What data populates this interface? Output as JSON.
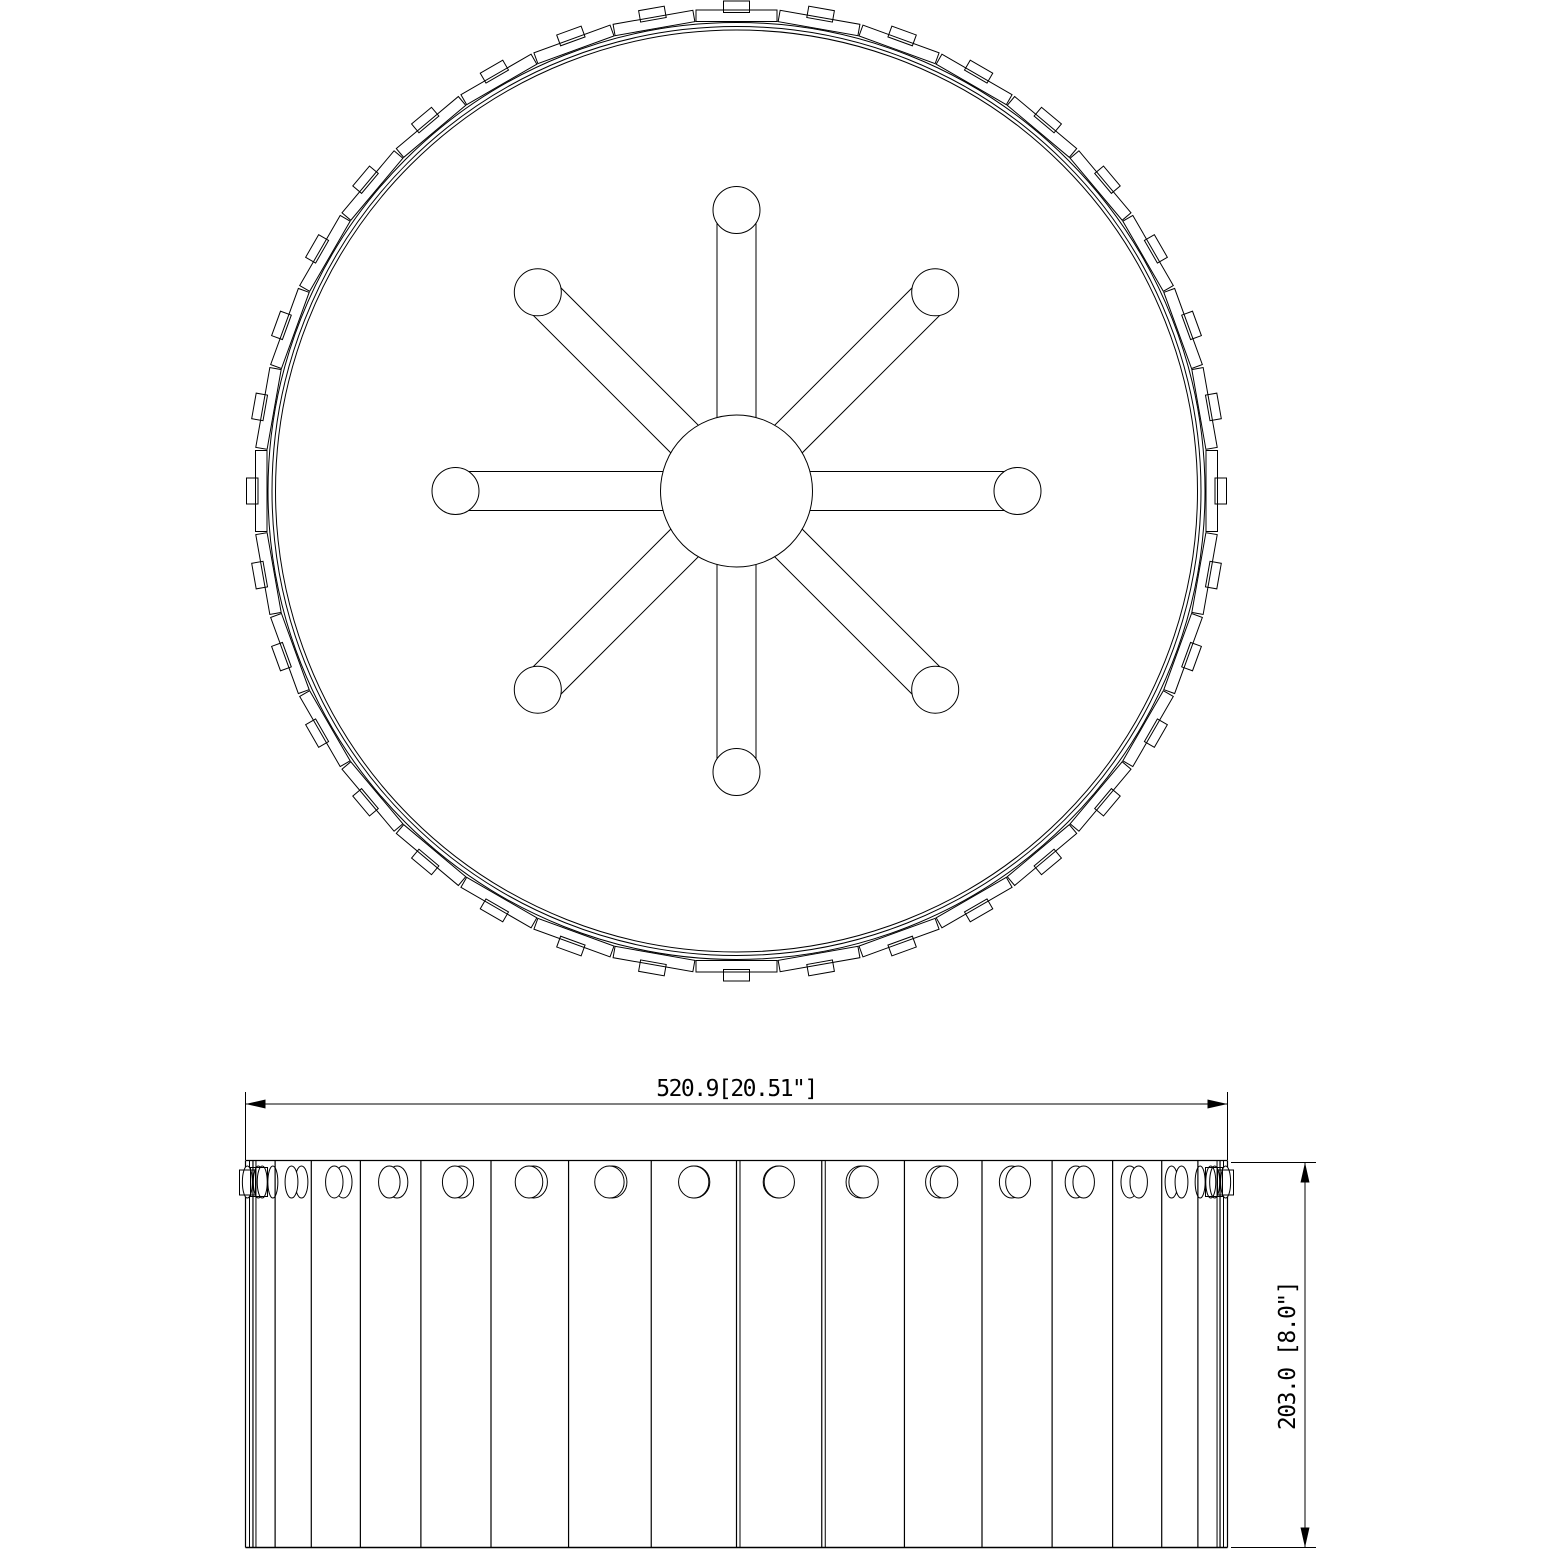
{
  "drawing": {
    "line_color": "#000000",
    "background_color": "#ffffff",
    "top_view": {
      "cx": 736.5,
      "cy": 491,
      "hub_radius": 76,
      "rim_radii": [
        461,
        464.5,
        468.5
      ],
      "panels": {
        "count": 36,
        "angle_step_deg": 10,
        "inner_radius": 469.5,
        "thickness": 11.5,
        "length": 81
      },
      "tabs": {
        "count": 36,
        "angle_step_deg": 10,
        "inner_radius": 478.5,
        "thickness": 11.5,
        "length": 26
      },
      "spokes": {
        "count": 8,
        "angle_step_deg": 45,
        "half_width": 19.5,
        "start_radius": 60,
        "end_radius": 281,
        "end_circle_radius": 23.5
      }
    },
    "front_view": {
      "left": 245.5,
      "right": 1227.5,
      "top": 1160.5,
      "bottom": 1547.5,
      "cx": 736.5,
      "cyl_radius": 491,
      "slat_step_deg": 10,
      "boundary_count": 19,
      "double_boundaries": [
        {
          "k": 0,
          "offset": 4
        },
        {
          "k": 1,
          "offset": 3
        },
        {
          "k": 9,
          "offset": 3.5
        },
        {
          "k": 10,
          "offset": 3.5
        },
        {
          "k": 17,
          "offset": -3
        },
        {
          "k": 18,
          "offset": -4
        }
      ],
      "holes": {
        "count": 18,
        "cy": 1182,
        "r": 16,
        "min_rx": 5,
        "rx_scale": 0.95,
        "offset_scale": 11
      },
      "end_tabs": [
        {
          "x": 239.5,
          "y": 1170,
          "w": 16,
          "h": 25
        },
        {
          "x": 250.5,
          "y": 1167.5,
          "w": 17,
          "h": 29
        },
        {
          "x": 1205.5,
          "y": 1167.5,
          "w": 17,
          "h": 29
        },
        {
          "x": 1217.5,
          "y": 1170,
          "w": 16,
          "h": 25
        }
      ]
    },
    "dimensions": {
      "width": {
        "label": "520.9[20.51\"]",
        "line_y": 1104,
        "x1": 245.5,
        "x2": 1227.5,
        "ext_y_top": 1092,
        "ext_y_bottom": 1160,
        "text_x": 736.5,
        "text_y": 1096
      },
      "height": {
        "label": "203.0 [8.0\"]",
        "line_x": 1305,
        "y1": 1162.5,
        "y2": 1547.5,
        "ext_x_inner": 1231,
        "ext_x_outer": 1316,
        "text_x": 1295,
        "text_y": 1356
      },
      "arrow": {
        "length": 20,
        "half_width": 4.5
      }
    }
  }
}
